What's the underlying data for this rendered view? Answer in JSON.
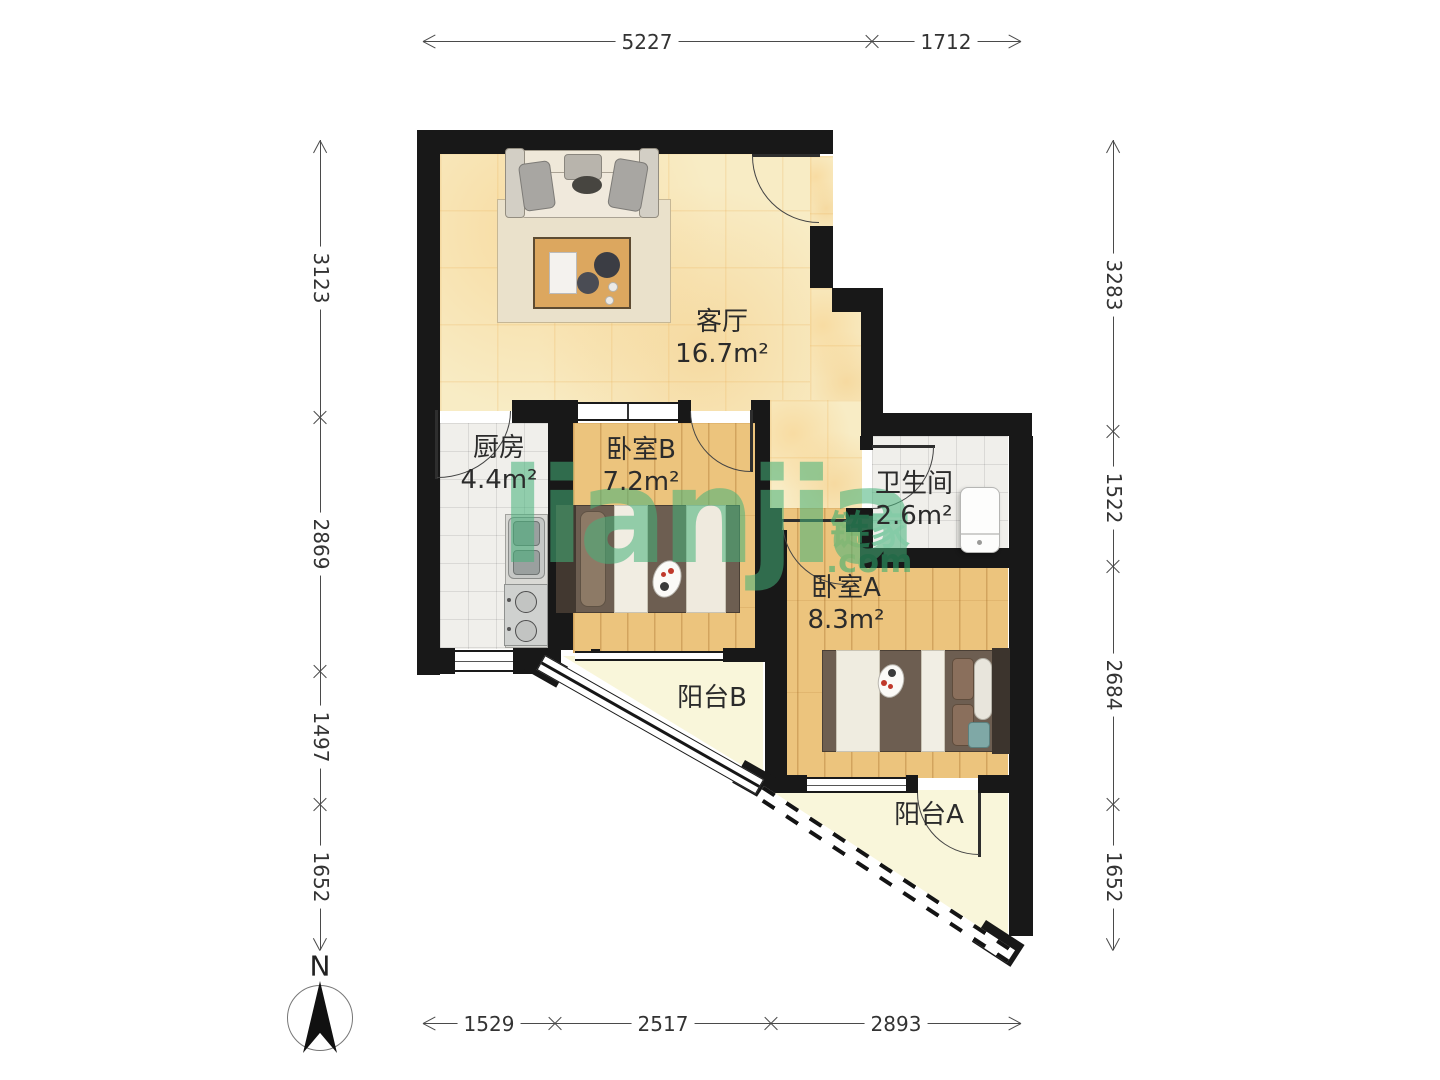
{
  "brand": {
    "watermark_en": "LIANJIA",
    "watermark_cn": "链家",
    "watermark_tld": ".com",
    "watermark_color": "#2fae70"
  },
  "compass": {
    "north_label": "N"
  },
  "rooms": {
    "living": {
      "name": "客厅",
      "area": "16.7m²"
    },
    "kitchen": {
      "name": "厨房",
      "area": "4.4m²"
    },
    "bedroom_b": {
      "name": "卧室B",
      "area": "7.2m²"
    },
    "bathroom": {
      "name": "卫生间",
      "area": "2.6m²"
    },
    "bedroom_a": {
      "name": "卧室A",
      "area": "8.3m²"
    },
    "balcony_b": {
      "name": "阳台B"
    },
    "balcony_a": {
      "name": "阳台A"
    }
  },
  "dimensions_mm": {
    "top": [
      "5227",
      "1712"
    ],
    "bottom": [
      "1529",
      "2517",
      "2893"
    ],
    "left": [
      "3123",
      "2869",
      "1497",
      "1652"
    ],
    "right": [
      "3283",
      "1522",
      "2684",
      "1652"
    ]
  },
  "colors": {
    "wall": "#181818",
    "marble_floor": "#f8ecc5",
    "wood_floor": "#ecc47d",
    "tile_floor": "#f0efeb",
    "balcony_floor": "#f9f6da",
    "watermark_green": "#2fae70"
  }
}
